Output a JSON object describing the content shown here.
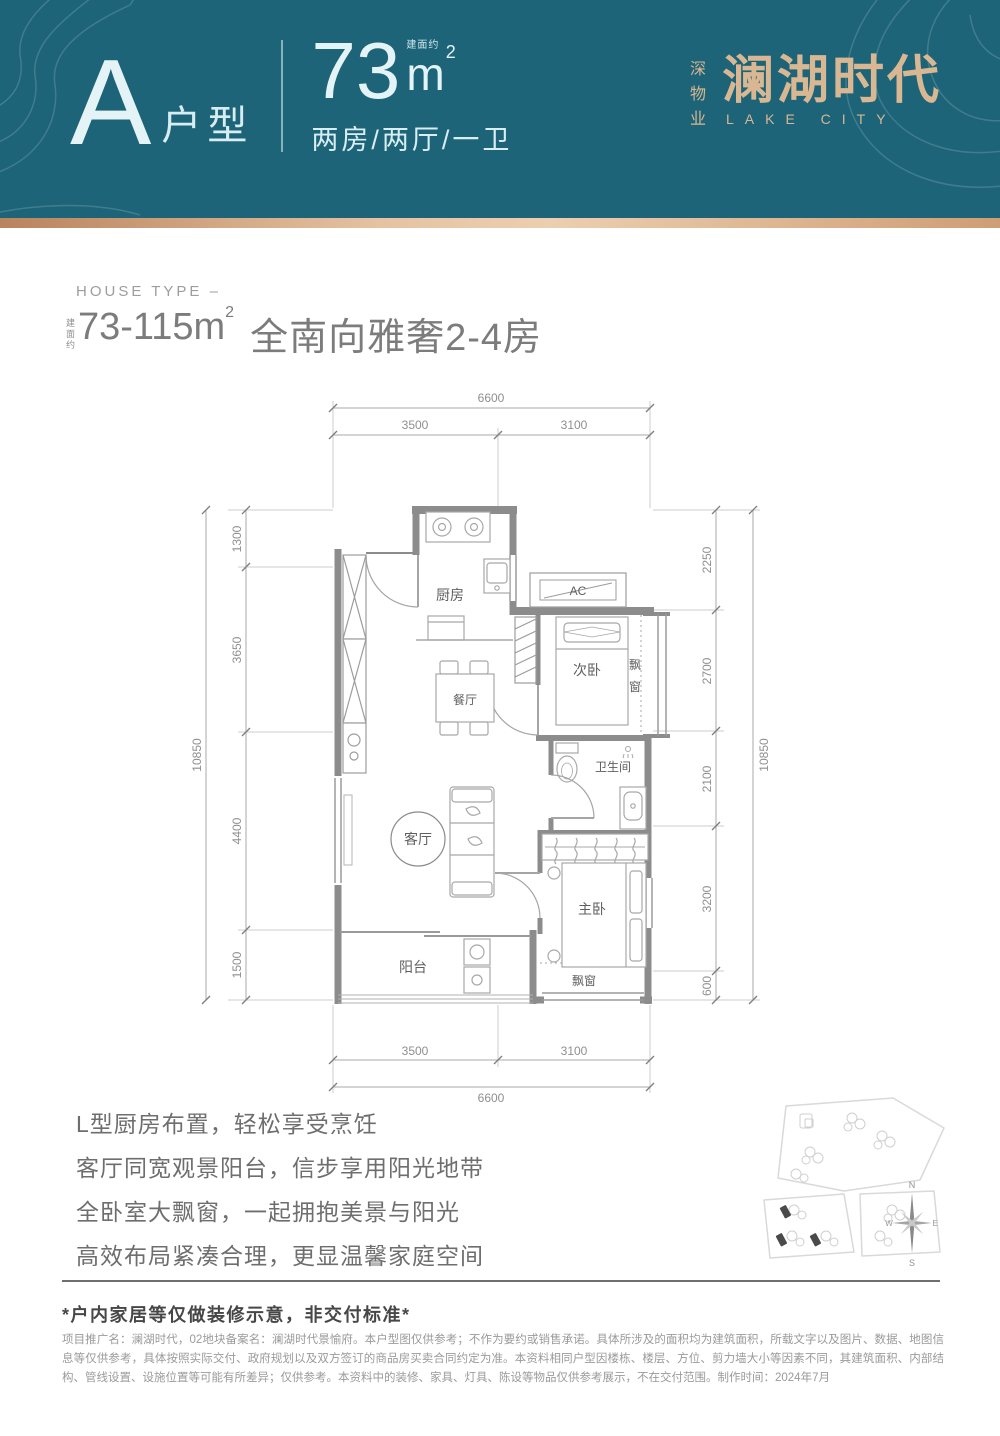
{
  "colors": {
    "header_bg": "#1d6478",
    "brand_gold": "#d9b792",
    "gradient_bar_left": "#b9835d",
    "gradient_bar_mid": "#eccfb0",
    "gradient_bar_right": "#cf9d74",
    "wall_gray": "#8c8c8c"
  },
  "header": {
    "type_letter": "A",
    "type_suffix": "户型",
    "area_value": "73",
    "area_unit": "m",
    "area_sup": "2",
    "area_note": "建面约",
    "layout_text": "两房/两厅/一卫",
    "brand_vertical": "深物业",
    "brand_name": "澜湖时代",
    "brand_en": "LAKE CITY"
  },
  "intro": {
    "eyebrow": "HOUSE TYPE –",
    "area_note": "建面约",
    "area_range": "73-115m",
    "area_sup": "2",
    "headline": "全南向雅奢2-4房"
  },
  "floorplan": {
    "dims": {
      "top": {
        "total": "6600",
        "seg1": "3500",
        "seg2": "3100"
      },
      "bottom": {
        "seg1": "3500",
        "seg2": "3100",
        "total": "6600"
      },
      "left": {
        "total": "10850",
        "segs": [
          "1300",
          "3650",
          "4400",
          "1500"
        ]
      },
      "right": {
        "total": "10850",
        "segs": [
          "2250",
          "2700",
          "2100",
          "3200",
          "600"
        ]
      }
    },
    "rooms": {
      "kitchen": "厨房",
      "ac": "AC",
      "bedroom2": "次卧",
      "bay_right_1": "飘",
      "bay_right_2": "窗",
      "dining": "餐厅",
      "bathroom": "卫生间",
      "living": "客厅",
      "master": "主卧",
      "balcony": "阳台",
      "bay_bottom": "飘窗"
    }
  },
  "features": [
    "L型厨房布置，轻松享受烹饪",
    "客厅同宽观景阳台，信步享用阳光地带",
    "全卧室大飘窗，一起拥抱美景与阳光",
    "高效布局紧凑合理，更显温馨家庭空间"
  ],
  "compass": {
    "n": "N",
    "e": "E",
    "s": "S",
    "w": "W"
  },
  "footer": {
    "notice": "*户内家居等仅做装修示意，非交付标准*",
    "disclaimer": "项目推广名：澜湖时代，02地块备案名：澜湖时代景愉府。本户型图仅供参考；不作为要约或销售承诺。具体所涉及的面积均为建筑面积，所载文字以及图片、数据、地图信息等仅供参考，具体按照实际交付、政府规划以及双方签订的商品房买卖合同约定为准。本资料相同户型因楼栋、楼层、方位、剪力墙大小等因素不同，其建筑面积、内部结构、管线设置、设施位置等可能有所差异；仅供参考。本资料中的装修、家具、灯具、陈设等物品仅供参考展示，不在交付范围。制作时间：2024年7月"
  }
}
